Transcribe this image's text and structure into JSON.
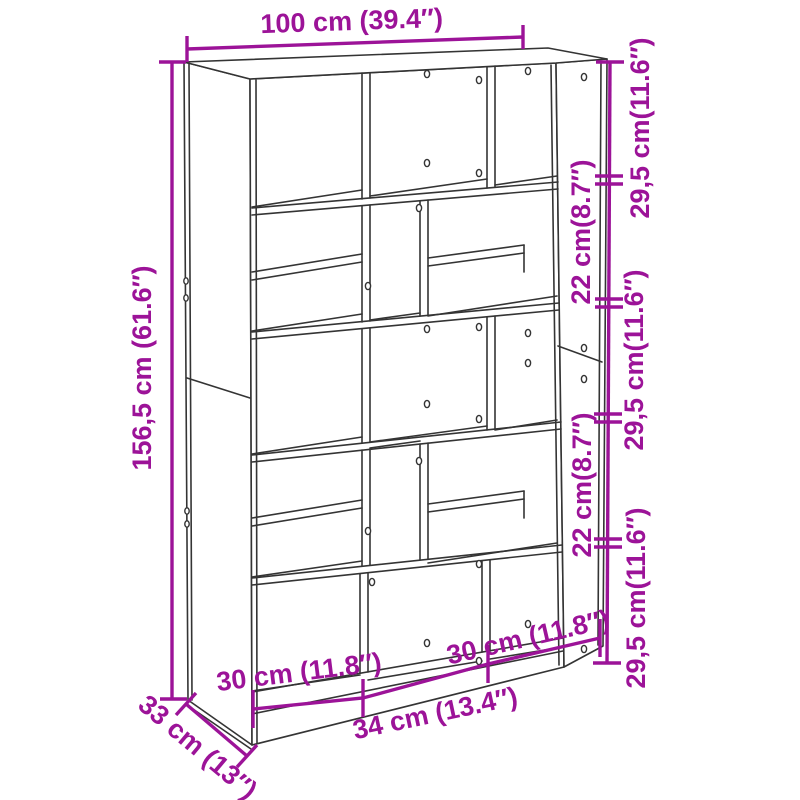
{
  "colors": {
    "dimension_accent": "#9C1398",
    "drawing_line": "#343434",
    "background": "#FFFFFF"
  },
  "diagram": {
    "subject": "bookcase room-divider dimension drawing",
    "labels": {
      "width_top": "100 cm (39.4″)",
      "height_left": "156,5 cm (61.6″)",
      "right_top_shelf": "29,5 cm(11.6″)",
      "right_upper_gap": "22 cm(8.7″)",
      "right_middle_shelf": "29,5 cm(11.6″)",
      "right_lower_gap": "22 cm(8.7″)",
      "right_bottom_shelf": "29,5 cm(11.6″)",
      "bottom_left_compartment": "30 cm (11.8″)",
      "bottom_middle_compartment": "34 cm (13.4″)",
      "bottom_right_compartment": "30 cm (11.8″)",
      "depth": "33 cm (13″)"
    }
  }
}
